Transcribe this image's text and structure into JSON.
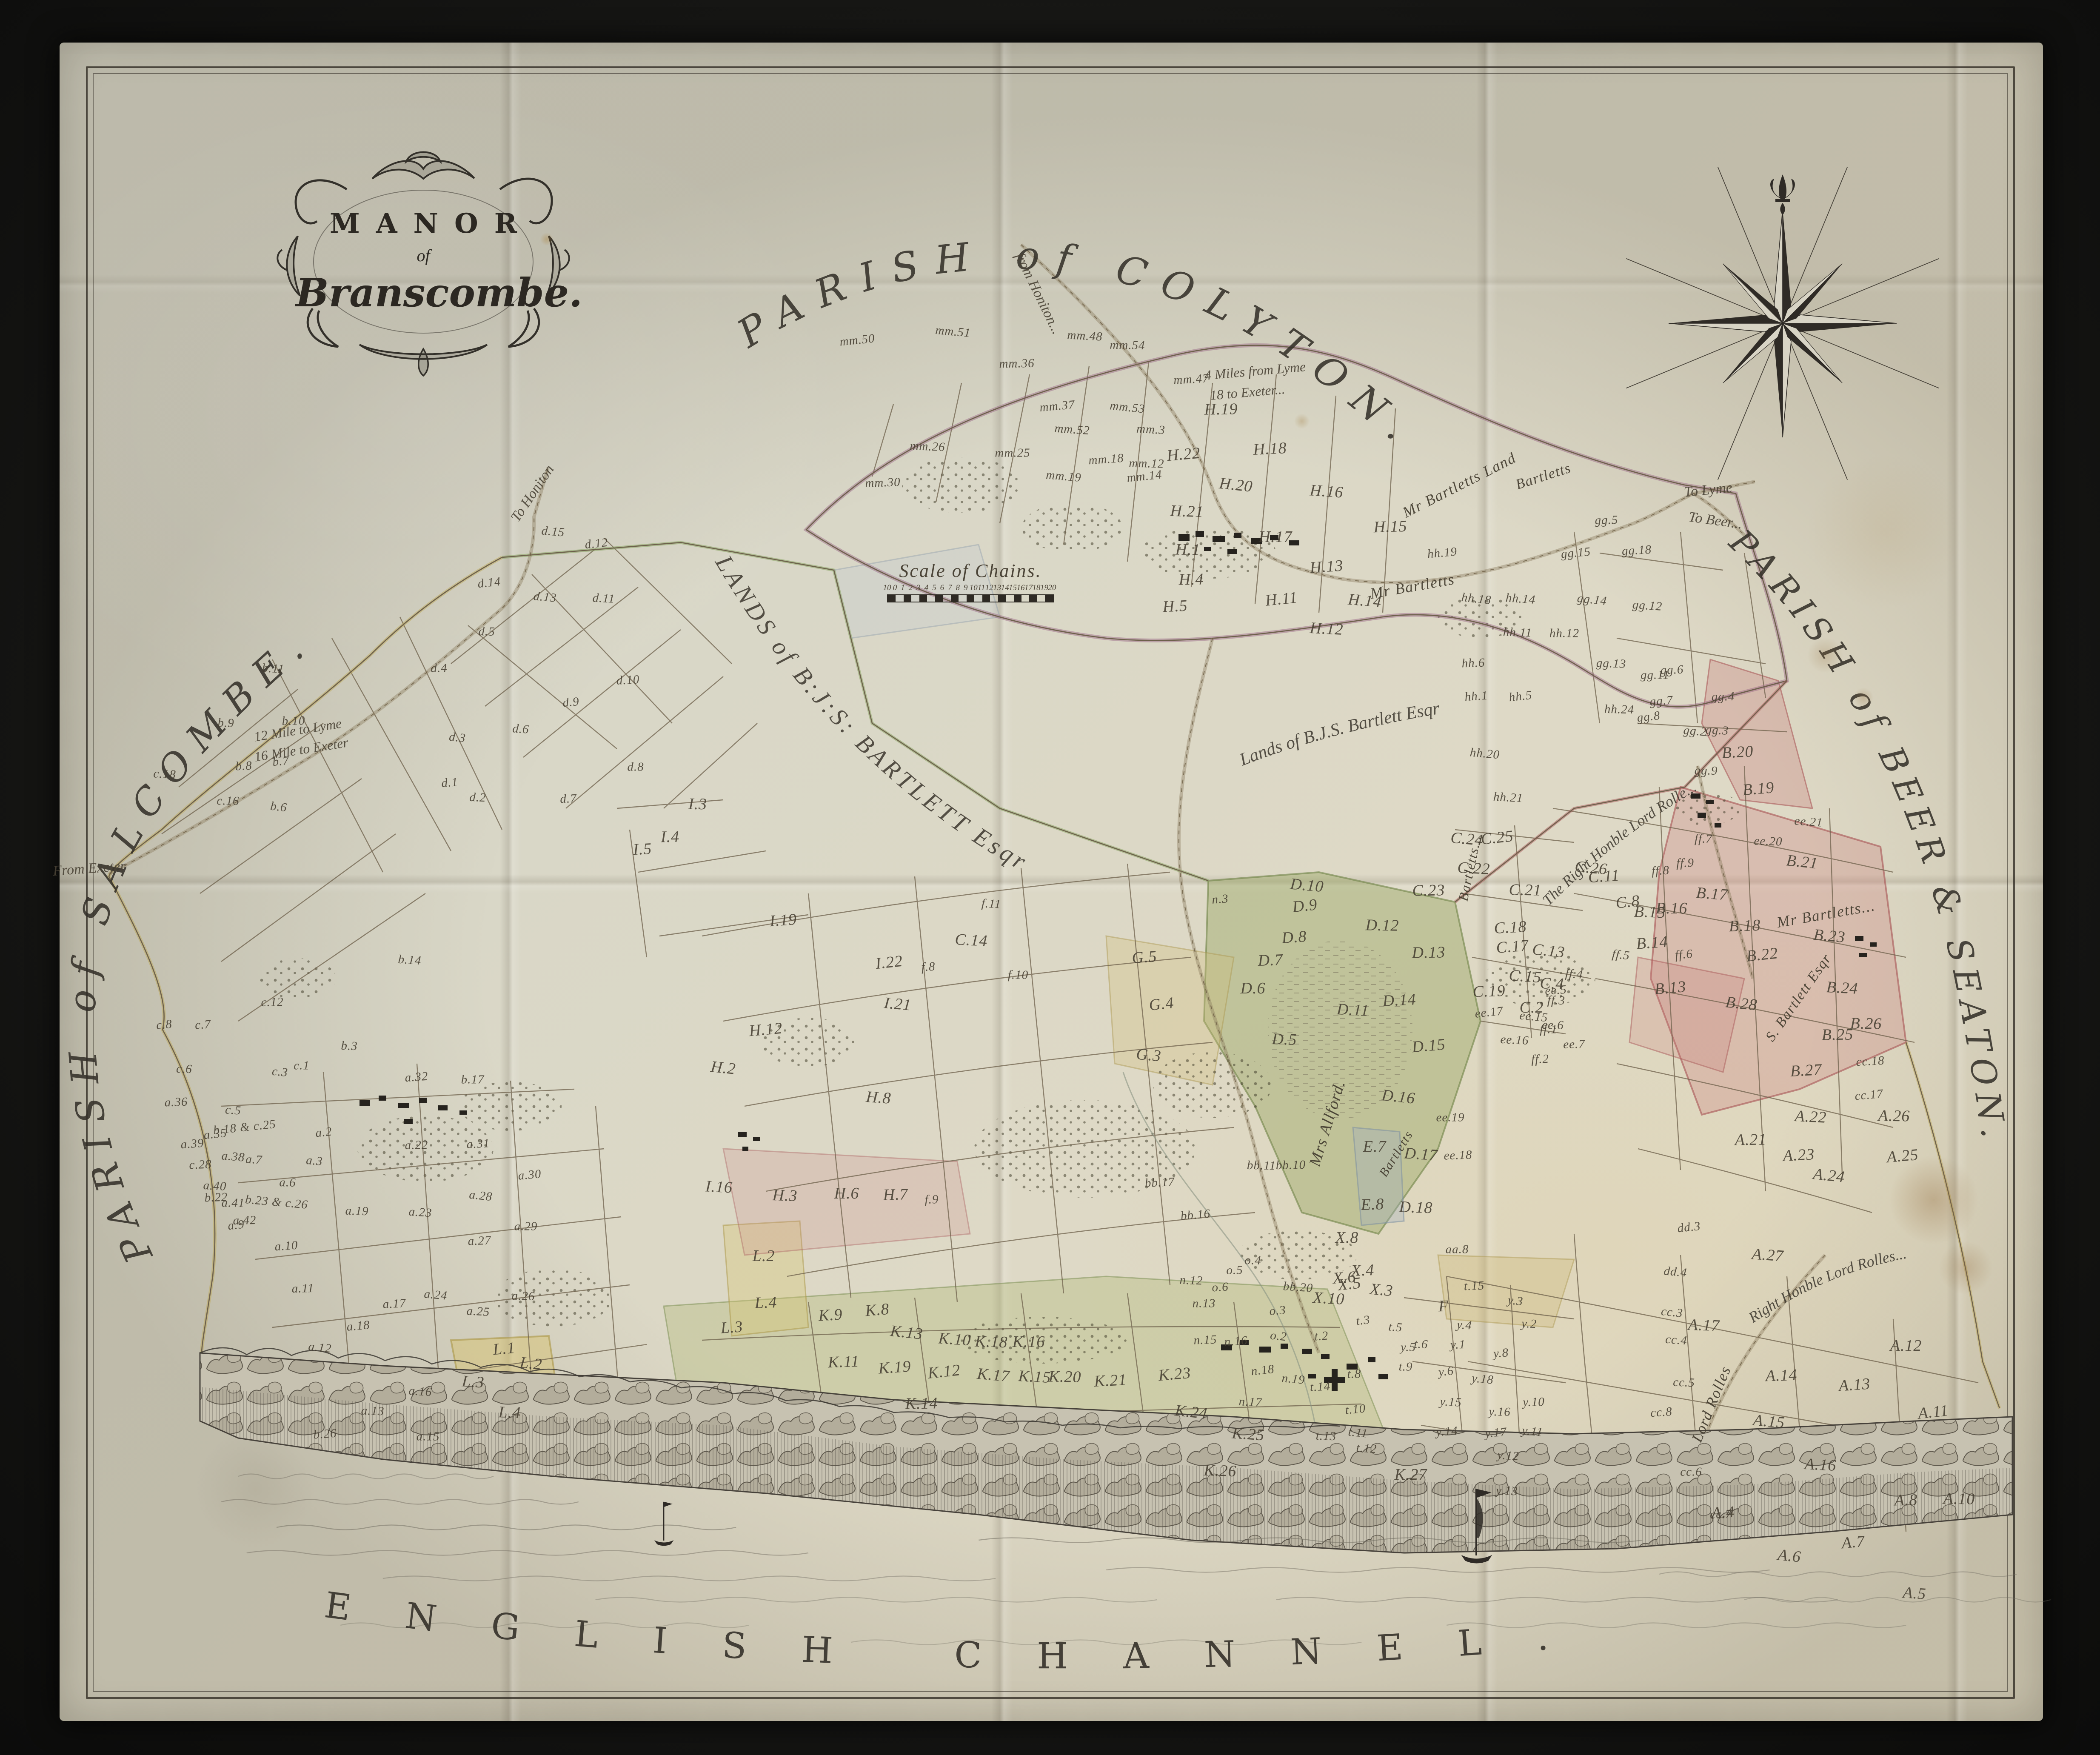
{
  "cartouche": {
    "title": "MANOR",
    "of": "of",
    "name": "Branscombe."
  },
  "edge_titles": {
    "top": "PARISH of COLYTON.",
    "left": "PARISH of SALCOMBE.",
    "right": "PARISH of BEER & SEATON.",
    "bottom": "ENGLISH CHANNEL."
  },
  "estate_titles": {
    "central": "LANDS of B:J:S: BARTLETT Esqr",
    "north_east": "Lands of B.J.S. Bartlett Esqr",
    "rolle_upper": "The Right Honble Lord Rolle...",
    "rolle_lower": "Right Honble Lord Rolles..."
  },
  "scale_bar": {
    "title": "Scale of Chains.",
    "ticks": [
      "10",
      "0",
      "1",
      "2",
      "3",
      "4",
      "5",
      "6",
      "7",
      "8",
      "9",
      "10",
      "11",
      "12",
      "13",
      "14",
      "15",
      "16",
      "17",
      "18",
      "19",
      "20"
    ]
  },
  "road_labels": [
    [
      "from Honiton...",
      2440,
      690,
      64,
      34
    ],
    [
      "To Honiton",
      1252,
      1160,
      -56,
      34
    ],
    [
      "To Lyme",
      4015,
      1152,
      -6,
      34
    ],
    [
      "To Beer...",
      4032,
      1224,
      8,
      34
    ],
    [
      "From Exeter",
      210,
      2042,
      -4,
      34
    ],
    [
      "12 Mile to Lyme",
      700,
      1716,
      -9,
      32
    ],
    [
      "16 Mile to Exeter",
      708,
      1762,
      -9,
      32
    ],
    [
      "4 Miles from Lyme",
      2950,
      872,
      -5,
      32
    ],
    [
      "18 to Exeter...",
      2932,
      922,
      -5,
      32
    ]
  ],
  "owner_labels": [
    [
      "Mr Bartletts Land",
      3430,
      1140,
      -27,
      36
    ],
    [
      "Bartletts",
      3628,
      1120,
      -18,
      34
    ],
    [
      "Mr Bartletts",
      3320,
      1378,
      -10,
      36
    ],
    [
      "Mr Bartletts...",
      4292,
      2148,
      -10,
      36
    ],
    [
      "Mrs Allford.",
      3120,
      2640,
      -73,
      38
    ],
    [
      "Bartletts...",
      3455,
      2040,
      -78,
      32
    ],
    [
      "Bartletts",
      3282,
      2712,
      -58,
      30
    ],
    [
      "Lord Rolles",
      4022,
      3300,
      -68,
      36
    ],
    [
      "S. Bartlett Esqr",
      4228,
      2345,
      -55,
      34
    ]
  ],
  "parcel_labels": [
    [
      "mm.50",
      2015,
      800
    ],
    [
      "mm.51",
      2240,
      780
    ],
    [
      "mm.48",
      2550,
      790
    ],
    [
      "mm.54",
      2650,
      812
    ],
    [
      "mm.36",
      2390,
      855
    ],
    [
      "mm.47",
      2800,
      892
    ],
    [
      "mm.37",
      2485,
      955
    ],
    [
      "mm.53",
      2650,
      958
    ],
    [
      "mm.52",
      2520,
      1010
    ],
    [
      "mm.26",
      2180,
      1050
    ],
    [
      "mm.25",
      2380,
      1065
    ],
    [
      "mm.30",
      2075,
      1135
    ],
    [
      "mm.18",
      2600,
      1080
    ],
    [
      "mm.14",
      2690,
      1120
    ],
    [
      "mm.19",
      2500,
      1120
    ],
    [
      "mm.3",
      2705,
      1010
    ],
    [
      "mm.12",
      2695,
      1090
    ],
    [
      "H.19",
      2870,
      962
    ],
    [
      "H.18",
      2985,
      1055
    ],
    [
      "H.22",
      2782,
      1068
    ],
    [
      "H.20",
      2905,
      1140
    ],
    [
      "H.16",
      3118,
      1155
    ],
    [
      "H.21",
      2790,
      1202
    ],
    [
      "H.17",
      2998,
      1262
    ],
    [
      "H.15",
      3268,
      1238
    ],
    [
      "H.13",
      3118,
      1332
    ],
    [
      "H.11",
      3012,
      1408
    ],
    [
      "H.14",
      3208,
      1412
    ],
    [
      "H.12",
      3118,
      1478
    ],
    [
      "H.1",
      2792,
      1292
    ],
    [
      "H.4",
      2800,
      1362
    ],
    [
      "H.5",
      2762,
      1425
    ],
    [
      "hh.19",
      3390,
      1300
    ],
    [
      "hh.18",
      3470,
      1408
    ],
    [
      "hh.14",
      3574,
      1408
    ],
    [
      "hh.11",
      3567,
      1487
    ],
    [
      "hh.12",
      3677,
      1489
    ],
    [
      "hh.6",
      3463,
      1559
    ],
    [
      "hh.1",
      3470,
      1637
    ],
    [
      "hh.5",
      3574,
      1637
    ],
    [
      "hh.20",
      3490,
      1772
    ],
    [
      "hh.21",
      3545,
      1875
    ],
    [
      "hh.24",
      3806,
      1668
    ],
    [
      "gg.5",
      3776,
      1223
    ],
    [
      "gg.18",
      3847,
      1294
    ],
    [
      "gg.15",
      3704,
      1300
    ],
    [
      "gg.14",
      3742,
      1410
    ],
    [
      "gg.12",
      3872,
      1424
    ],
    [
      "gg.13",
      3787,
      1560
    ],
    [
      "gg.11",
      3890,
      1587
    ],
    [
      "gg.6",
      3930,
      1575
    ],
    [
      "gg.7",
      3905,
      1648
    ],
    [
      "gg.8",
      3875,
      1685
    ],
    [
      "gg.2",
      3984,
      1719
    ],
    [
      "gg.3",
      4036,
      1717
    ],
    [
      "gg.9",
      4010,
      1812
    ],
    [
      "gg.4",
      4050,
      1638
    ],
    [
      "B.20",
      4084,
      1768
    ],
    [
      "B.19",
      4133,
      1854
    ],
    [
      "B.21",
      4236,
      2026
    ],
    [
      "B.17",
      4024,
      2101
    ],
    [
      "B.15",
      3878,
      2144
    ],
    [
      "B.16",
      3929,
      2135
    ],
    [
      "B.18",
      4101,
      2176
    ],
    [
      "B.14",
      3883,
      2216
    ],
    [
      "B.22",
      4142,
      2244
    ],
    [
      "B.23",
      4300,
      2200
    ],
    [
      "B.24",
      4330,
      2322
    ],
    [
      "B.26",
      4386,
      2406
    ],
    [
      "B.25",
      4319,
      2432
    ],
    [
      "B.27",
      4245,
      2516
    ],
    [
      "B.13",
      3926,
      2322
    ],
    [
      "B.28",
      4093,
      2359
    ],
    [
      "ee.21",
      4251,
      1932
    ],
    [
      "ee.20",
      4156,
      1978
    ],
    [
      "ee.19",
      3409,
      2627
    ],
    [
      "ee.18",
      3427,
      2716
    ],
    [
      "ee.5",
      3657,
      2328
    ],
    [
      "ee.17",
      3500,
      2380
    ],
    [
      "ee.15",
      3605,
      2390
    ],
    [
      "ee.16",
      3560,
      2445
    ],
    [
      "ee.6",
      3650,
      2410
    ],
    [
      "ee.7",
      3700,
      2455
    ],
    [
      "cc.18",
      4396,
      2495
    ],
    [
      "cc.17",
      4393,
      2574
    ],
    [
      "cc.3",
      3930,
      3085
    ],
    [
      "cc.4",
      3940,
      3150
    ],
    [
      "cc.5",
      3958,
      3250
    ],
    [
      "cc.6",
      3975,
      3460
    ],
    [
      "cc.7",
      4045,
      3560
    ],
    [
      "cc.8",
      3905,
      3320
    ],
    [
      "dd.3",
      3970,
      2885
    ],
    [
      "dd.4",
      3938,
      2990
    ],
    [
      "A.22",
      4256,
      2625
    ],
    [
      "A.26",
      4452,
      2623
    ],
    [
      "A.21",
      4115,
      2679
    ],
    [
      "A.23",
      4228,
      2715
    ],
    [
      "A.25",
      4472,
      2717
    ],
    [
      "A.24",
      4299,
      2763
    ],
    [
      "A.27",
      4155,
      2950
    ],
    [
      "A.17",
      4005,
      3115
    ],
    [
      "A.12",
      4480,
      3163
    ],
    [
      "A.14",
      4187,
      3233
    ],
    [
      "A.13",
      4359,
      3255
    ],
    [
      "A.11",
      4544,
      3319
    ],
    [
      "A.15",
      4158,
      3341
    ],
    [
      "A.16",
      4279,
      3443
    ],
    [
      "A.10",
      4605,
      3523
    ],
    [
      "A.8",
      4480,
      3526
    ],
    [
      "A.4",
      4050,
      3555
    ],
    [
      "A.7",
      4356,
      3625
    ],
    [
      "A.6",
      4206,
      3657
    ],
    [
      "A.5",
      4500,
      3745
    ],
    [
      "D.5",
      3019,
      2443
    ],
    [
      "D.6",
      2945,
      2323
    ],
    [
      "D.7",
      2986,
      2257
    ],
    [
      "D.8",
      3042,
      2203
    ],
    [
      "D.9",
      3067,
      2129
    ],
    [
      "D.10",
      3072,
      2081
    ],
    [
      "D.11",
      3180,
      2374
    ],
    [
      "D.12",
      3249,
      2175
    ],
    [
      "D.13",
      3358,
      2239
    ],
    [
      "D.14",
      3289,
      2351
    ],
    [
      "D.15",
      3358,
      2458
    ],
    [
      "D.16",
      3287,
      2578
    ],
    [
      "D.17",
      3340,
      2713
    ],
    [
      "D.18",
      3328,
      2838
    ],
    [
      "E.7",
      3231,
      2695
    ],
    [
      "E.8",
      3226,
      2831
    ],
    [
      "n.3",
      2868,
      2114
    ],
    [
      "C.25",
      3519,
      1969
    ],
    [
      "C.24",
      3448,
      1972
    ],
    [
      "C.22",
      3464,
      2041
    ],
    [
      "C.21",
      3585,
      2092
    ],
    [
      "C.23",
      3358,
      2093
    ],
    [
      "C.18",
      3550,
      2180
    ],
    [
      "C.17",
      3555,
      2225
    ],
    [
      "C.13",
      3640,
      2235
    ],
    [
      "C.15",
      3585,
      2295
    ],
    [
      "C.4",
      3648,
      2312
    ],
    [
      "C.2",
      3600,
      2368
    ],
    [
      "C.19",
      3500,
      2330
    ],
    [
      "C.11",
      3770,
      2060
    ],
    [
      "C.8",
      3826,
      2120
    ],
    [
      "C.26",
      3740,
      2040
    ],
    [
      "C.14",
      2283,
      2210
    ],
    [
      "ff.7",
      4004,
      1972
    ],
    [
      "ff.9",
      3961,
      2029
    ],
    [
      "ff.8",
      3903,
      2047
    ],
    [
      "ff.6",
      3958,
      2244
    ],
    [
      "ff.5",
      3810,
      2245
    ],
    [
      "ff.4",
      3700,
      2290
    ],
    [
      "ff.3",
      3658,
      2352
    ],
    [
      "ff.1",
      3640,
      2420
    ],
    [
      "ff.2",
      3620,
      2490
    ],
    [
      "G.5",
      2690,
      2250
    ],
    [
      "G.4",
      2730,
      2360
    ],
    [
      "G.3",
      2700,
      2480
    ],
    [
      "f.11",
      2330,
      2125
    ],
    [
      "f.10",
      2393,
      2292
    ],
    [
      "f.9",
      2190,
      2820
    ],
    [
      "f.8",
      2182,
      2273
    ],
    [
      "H.12",
      1800,
      2420
    ],
    [
      "H.2",
      1700,
      2510
    ],
    [
      "H.8",
      2065,
      2580
    ],
    [
      "H.3",
      1845,
      2810
    ],
    [
      "H.6",
      1990,
      2805
    ],
    [
      "H.7",
      2105,
      2808
    ],
    [
      "I.19",
      1841,
      2163
    ],
    [
      "I.22",
      2090,
      2262
    ],
    [
      "I.21",
      2110,
      2360
    ],
    [
      "I.16",
      1690,
      2790
    ],
    [
      "I.3",
      1640,
      1890
    ],
    [
      "I.4",
      1575,
      1967
    ],
    [
      "I.5",
      1510,
      1996
    ],
    [
      "L.1",
      1185,
      3170
    ],
    [
      "L.2",
      1248,
      3205
    ],
    [
      "L.3",
      1112,
      3248
    ],
    [
      "L.4",
      1198,
      3320
    ],
    [
      "L.2",
      1795,
      2952
    ],
    [
      "L.4",
      1800,
      3062
    ],
    [
      "L.3",
      1720,
      3120
    ],
    [
      "d.12",
      1402,
      1278
    ],
    [
      "d.13",
      1281,
      1404
    ],
    [
      "d.11",
      1419,
      1407
    ],
    [
      "d.5",
      1144,
      1485
    ],
    [
      "d.4",
      1032,
      1571
    ],
    [
      "d.10",
      1476,
      1599
    ],
    [
      "d.9",
      1342,
      1651
    ],
    [
      "d.3",
      1075,
      1734
    ],
    [
      "d.6",
      1224,
      1714
    ],
    [
      "d.2",
      1123,
      1875
    ],
    [
      "d.8",
      1494,
      1803
    ],
    [
      "d.7",
      1336,
      1878
    ],
    [
      "d.1",
      1057,
      1840
    ],
    [
      "d.14",
      1150,
      1370
    ],
    [
      "d.15",
      1300,
      1250
    ],
    [
      "b.11",
      642,
      1572
    ],
    [
      "b.9",
      531,
      1700
    ],
    [
      "b.10",
      690,
      1695
    ],
    [
      "b.8",
      573,
      1801
    ],
    [
      "b.7",
      660,
      1790
    ],
    [
      "b.6",
      655,
      1897
    ],
    [
      "b.14",
      963,
      2257
    ],
    [
      "b.3",
      821,
      2459
    ],
    [
      "b.17",
      1111,
      2538
    ],
    [
      "b.22",
      508,
      2815
    ],
    [
      "b.26",
      764,
      3371
    ],
    [
      "b.18 & c.25",
      575,
      2650
    ],
    [
      "b.23 & c.26",
      650,
      2826
    ],
    [
      "c.18",
      387,
      1820
    ],
    [
      "c.16",
      536,
      1883
    ],
    [
      "c.12",
      640,
      2356
    ],
    [
      "c.7",
      477,
      2409
    ],
    [
      "c.8",
      386,
      2409
    ],
    [
      "c.3",
      658,
      2520
    ],
    [
      "c.5",
      548,
      2610
    ],
    [
      "c.6",
      433,
      2513
    ],
    [
      "c.1",
      709,
      2505
    ],
    [
      "c.28",
      471,
      2738
    ],
    [
      "a.32",
      979,
      2532
    ],
    [
      "a.2",
      761,
      2662
    ],
    [
      "a.3",
      739,
      2729
    ],
    [
      "a.7",
      597,
      2726
    ],
    [
      "a.6",
      676,
      2780
    ],
    [
      "a.22",
      979,
      2692
    ],
    [
      "a.31",
      1124,
      2689
    ],
    [
      "a.30",
      1245,
      2762
    ],
    [
      "a.28",
      1130,
      2811
    ],
    [
      "a.23",
      988,
      2850
    ],
    [
      "a.19",
      839,
      2847
    ],
    [
      "a.29",
      1236,
      2883
    ],
    [
      "a.27",
      1127,
      2917
    ],
    [
      "a.10",
      673,
      2929
    ],
    [
      "a.9",
      555,
      2880
    ],
    [
      "a.24",
      1024,
      3044
    ],
    [
      "a.25",
      1124,
      3083
    ],
    [
      "a.26",
      1230,
      3047
    ],
    [
      "a.11",
      712,
      3029
    ],
    [
      "a.17",
      927,
      3065
    ],
    [
      "a.18",
      842,
      3117
    ],
    [
      "a.12",
      752,
      3168
    ],
    [
      "a.16",
      988,
      3271
    ],
    [
      "a.13",
      876,
      3317
    ],
    [
      "a.15",
      1006,
      3377
    ],
    [
      "a.36",
      414,
      2591
    ],
    [
      "a.39",
      452,
      2689
    ],
    [
      "a.35",
      506,
      2666
    ],
    [
      "a.38",
      548,
      2719
    ],
    [
      "a.40",
      505,
      2788
    ],
    [
      "a.41",
      548,
      2828
    ],
    [
      "a.42",
      575,
      2869
    ],
    [
      "K.9",
      1952,
      3091
    ],
    [
      "K.8",
      2062,
      3079
    ],
    [
      "K.13",
      2131,
      3132
    ],
    [
      "K.10",
      2244,
      3148
    ],
    [
      "K.18",
      2330,
      3154
    ],
    [
      "K.16",
      2418,
      3154
    ],
    [
      "K.11",
      1983,
      3201
    ],
    [
      "K.19",
      2103,
      3214
    ],
    [
      "K.12",
      2219,
      3224
    ],
    [
      "K.17",
      2335,
      3232
    ],
    [
      "K.15",
      2432,
      3236
    ],
    [
      "K.20",
      2503,
      3236
    ],
    [
      "K.14",
      2166,
      3299
    ],
    [
      "K.21",
      2610,
      3245
    ],
    [
      "K.23",
      2761,
      3230
    ],
    [
      "K.24",
      2800,
      3319
    ],
    [
      "K.25",
      2934,
      3371
    ],
    [
      "K.26",
      2868,
      3457
    ],
    [
      "K.27",
      3316,
      3466
    ],
    [
      "t.15",
      3465,
      3023
    ],
    [
      "t.2",
      3106,
      3141
    ],
    [
      "t.3",
      3204,
      3104
    ],
    [
      "t.5",
      3280,
      3120
    ],
    [
      "t.6",
      3340,
      3160
    ],
    [
      "t.9",
      3304,
      3213
    ],
    [
      "t.8",
      3183,
      3230
    ],
    [
      "t.14",
      3103,
      3260
    ],
    [
      "t.10",
      3186,
      3313
    ],
    [
      "t.11",
      3192,
      3368
    ],
    [
      "t.12",
      3212,
      3405
    ],
    [
      "t.13",
      3117,
      3376
    ],
    [
      "X.8",
      3166,
      2909
    ],
    [
      "X.4",
      3203,
      2986
    ],
    [
      "X.6",
      3160,
      3003
    ],
    [
      "X.5",
      3172,
      3018
    ],
    [
      "X.3",
      3247,
      3032
    ],
    [
      "X.10",
      3123,
      3052
    ],
    [
      "o.4",
      2945,
      2963
    ],
    [
      "o.5",
      2902,
      2986
    ],
    [
      "o.6",
      2868,
      3026
    ],
    [
      "o.3",
      3003,
      3081
    ],
    [
      "o.2",
      3005,
      3141
    ],
    [
      "bb.20",
      3051,
      3026
    ],
    [
      "n.12",
      2800,
      3010
    ],
    [
      "n.13",
      2830,
      3064
    ],
    [
      "n.15",
      2833,
      3150
    ],
    [
      "n.16",
      2905,
      3153
    ],
    [
      "n.18",
      2968,
      3221
    ],
    [
      "n.19",
      3040,
      3242
    ],
    [
      "n.17",
      2939,
      3296
    ],
    [
      "bb.11",
      2965,
      2740
    ],
    [
      "bb.10",
      3034,
      2739
    ],
    [
      "bb.17",
      2726,
      2780
    ],
    [
      "bb.16",
      2810,
      2856
    ],
    [
      "y.3",
      3562,
      3058
    ],
    [
      "y.4",
      3442,
      3115
    ],
    [
      "y.2",
      3594,
      3112
    ],
    [
      "y.5",
      3310,
      3167
    ],
    [
      "y.1",
      3427,
      3161
    ],
    [
      "y.8",
      3528,
      3181
    ],
    [
      "y.6",
      3399,
      3224
    ],
    [
      "y.18",
      3485,
      3242
    ],
    [
      "y.15",
      3410,
      3296
    ],
    [
      "y.16",
      3525,
      3319
    ],
    [
      "y.10",
      3605,
      3296
    ],
    [
      "y.14",
      3401,
      3365
    ],
    [
      "y.17",
      3516,
      3368
    ],
    [
      "y.11",
      3602,
      3365
    ],
    [
      "y.12",
      3545,
      3422
    ],
    [
      "y.13",
      3542,
      3505
    ],
    [
      "aa.8",
      3425,
      2937
    ],
    [
      "F",
      3393,
      3070
    ]
  ]
}
